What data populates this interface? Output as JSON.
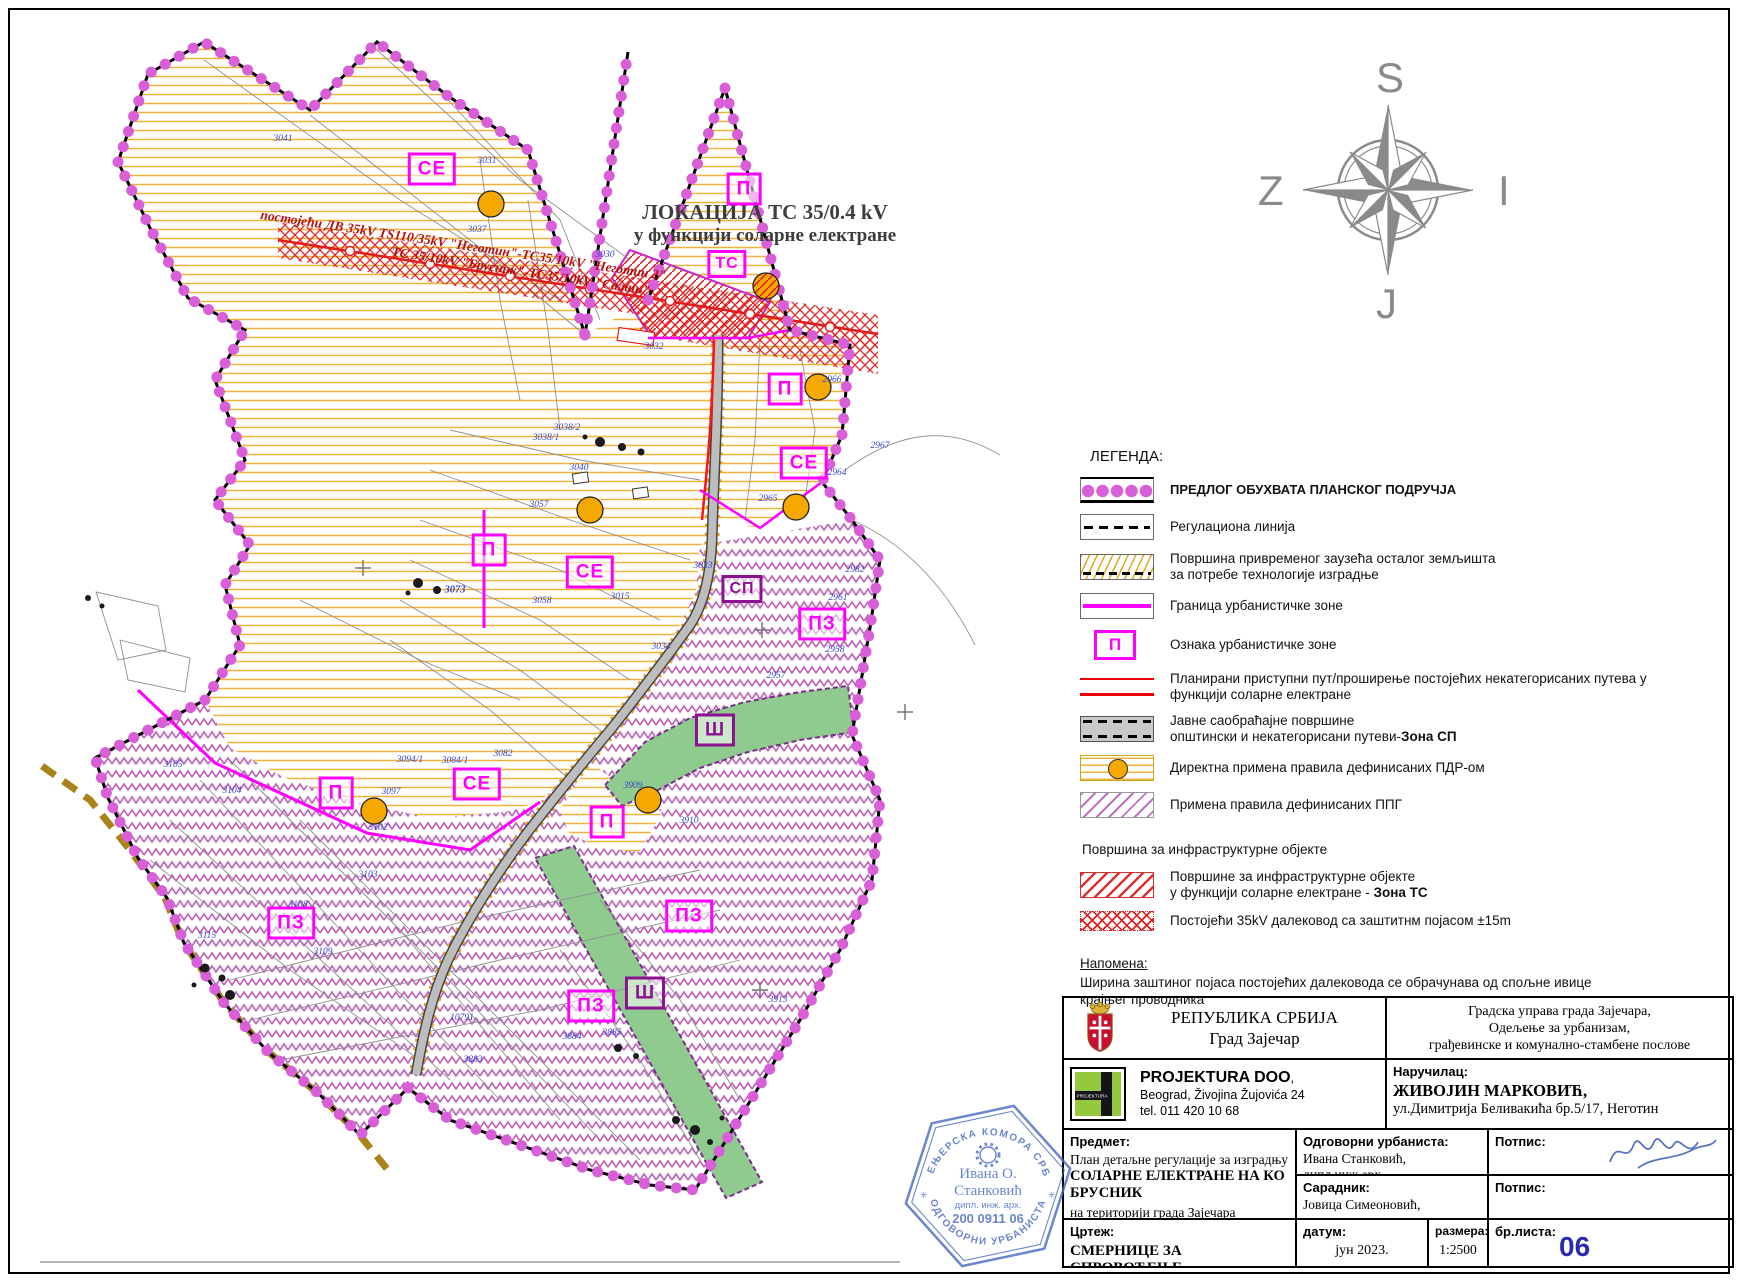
{
  "colors": {
    "accent_magenta": "#ff00ff",
    "boundary_dots": "#d95fd9",
    "dark_zone": "#8b1191",
    "yellow_hatch": "#efb23a",
    "purple_hatch": "#bb63bb",
    "green_zone": "#8fca8f",
    "red_corridor": "#e31b1b",
    "blue_parcel": "#3747cf",
    "sheet_number_blue": "#2b2bb0",
    "stamp_blue": "#4a6cc4",
    "compass_gray": "#8a8a8a"
  },
  "map": {
    "title": {
      "line1": "ЛОКАЦИЈА ТС 35/0.4 kV",
      "line2": "у функцији соларне електране"
    },
    "powerline_label": {
      "line1": "постојећи ДВ 35kV TS110/35kV \"Неготин\"-ТС35/10kV \"Неготин 2\"",
      "line2": "ТС 35/10kV \"Брусник\"-ТС35/10kV \"Салаш\""
    },
    "zone_labels": [
      {
        "text": "СЕ",
        "x": 432,
        "y": 169,
        "style": ""
      },
      {
        "text": "П",
        "x": 744,
        "y": 189,
        "style": ""
      },
      {
        "text": "ТС",
        "x": 727,
        "y": 264,
        "style": "small"
      },
      {
        "text": "П",
        "x": 785,
        "y": 389,
        "style": ""
      },
      {
        "text": "СЕ",
        "x": 804,
        "y": 463,
        "style": ""
      },
      {
        "text": "П",
        "x": 489,
        "y": 550,
        "style": ""
      },
      {
        "text": "СЕ",
        "x": 590,
        "y": 572,
        "style": ""
      },
      {
        "text": "СП",
        "x": 742,
        "y": 589,
        "style": "dark small"
      },
      {
        "text": "ПЗ",
        "x": 822,
        "y": 624,
        "style": ""
      },
      {
        "text": "Ш",
        "x": 715,
        "y": 730,
        "style": "dark"
      },
      {
        "text": "СЕ",
        "x": 477,
        "y": 784,
        "style": ""
      },
      {
        "text": "П",
        "x": 336,
        "y": 793,
        "style": ""
      },
      {
        "text": "П",
        "x": 607,
        "y": 822,
        "style": ""
      },
      {
        "text": "ПЗ",
        "x": 291,
        "y": 923,
        "style": ""
      },
      {
        "text": "ПЗ",
        "x": 689,
        "y": 916,
        "style": ""
      },
      {
        "text": "Ш",
        "x": 645,
        "y": 993,
        "style": "dark"
      },
      {
        "text": "ПЗ",
        "x": 591,
        "y": 1006,
        "style": ""
      }
    ],
    "parcel_numbers": [
      {
        "text": "3041",
        "x": 283,
        "y": 139
      },
      {
        "text": "3031",
        "x": 487,
        "y": 161
      },
      {
        "text": "3037",
        "x": 477,
        "y": 230
      },
      {
        "text": "3030",
        "x": 605,
        "y": 255
      },
      {
        "text": "3032",
        "x": 654,
        "y": 347
      },
      {
        "text": "3038/2",
        "x": 567,
        "y": 428
      },
      {
        "text": "3038/1",
        "x": 546,
        "y": 438
      },
      {
        "text": "3040",
        "x": 579,
        "y": 468
      },
      {
        "text": "3057",
        "x": 539,
        "y": 505
      },
      {
        "text": "3073",
        "x": 455,
        "y": 590,
        "bold": true
      },
      {
        "text": "3058",
        "x": 542,
        "y": 601
      },
      {
        "text": "3015",
        "x": 620,
        "y": 597
      },
      {
        "text": "3033",
        "x": 703,
        "y": 566
      },
      {
        "text": "3034",
        "x": 661,
        "y": 647
      },
      {
        "text": "2966",
        "x": 832,
        "y": 380
      },
      {
        "text": "2964",
        "x": 837,
        "y": 473
      },
      {
        "text": "2965",
        "x": 768,
        "y": 499
      },
      {
        "text": "2967",
        "x": 880,
        "y": 446
      },
      {
        "text": "2982",
        "x": 855,
        "y": 570
      },
      {
        "text": "2961",
        "x": 838,
        "y": 598
      },
      {
        "text": "2958",
        "x": 835,
        "y": 650
      },
      {
        "text": "2957",
        "x": 776,
        "y": 676
      },
      {
        "text": "3105",
        "x": 173,
        "y": 765
      },
      {
        "text": "3104",
        "x": 232,
        "y": 791
      },
      {
        "text": "3097",
        "x": 391,
        "y": 792
      },
      {
        "text": "3102",
        "x": 378,
        "y": 828
      },
      {
        "text": "3094/1",
        "x": 410,
        "y": 760
      },
      {
        "text": "3084/1",
        "x": 455,
        "y": 761
      },
      {
        "text": "3082",
        "x": 503,
        "y": 754
      },
      {
        "text": "3103",
        "x": 368,
        "y": 875
      },
      {
        "text": "3108",
        "x": 298,
        "y": 905
      },
      {
        "text": "3115",
        "x": 207,
        "y": 936
      },
      {
        "text": "3109",
        "x": 323,
        "y": 952
      },
      {
        "text": "10791",
        "x": 462,
        "y": 1018
      },
      {
        "text": "3885",
        "x": 612,
        "y": 1033
      },
      {
        "text": "3884",
        "x": 572,
        "y": 1037
      },
      {
        "text": "3883",
        "x": 473,
        "y": 1060
      },
      {
        "text": "3913",
        "x": 778,
        "y": 1000
      },
      {
        "text": "3910",
        "x": 689,
        "y": 821
      },
      {
        "text": "3909",
        "x": 633,
        "y": 786
      }
    ],
    "symbols": {
      "pdr_circles": [
        {
          "x": 491,
          "y": 204
        },
        {
          "x": 818,
          "y": 387
        },
        {
          "x": 796,
          "y": 507
        },
        {
          "x": 590,
          "y": 510
        },
        {
          "x": 374,
          "y": 811
        },
        {
          "x": 648,
          "y": 800
        }
      ],
      "ts_circle": {
        "x": 766,
        "y": 286
      }
    }
  },
  "compass": {
    "north": "S",
    "west": "Z",
    "east": "I",
    "south": "J"
  },
  "legend": {
    "title": "ЛЕГЕНДА:",
    "items": [
      {
        "swatch": "dots",
        "bold": true,
        "lines": [
          "ПРЕДЛОГ ОБУХВАТА ПЛАНСКОГ ПОДРУЧЈА"
        ]
      },
      {
        "swatch": "dash",
        "lines": [
          "Регулациона линија"
        ]
      },
      {
        "swatch": "temp",
        "lines": [
          "Површина привременог заузећа осталог земљишта",
          "за потребе технологије изградње"
        ]
      },
      {
        "swatch": "magline",
        "lines": [
          "Граница урбанистичке зоне"
        ]
      },
      {
        "swatch": "pbox",
        "letter": "П",
        "lines": [
          "Ознака урбанистичке зоне"
        ]
      },
      {
        "swatch": "redlines",
        "lines": [
          "Планирани приступни пут/проширење постојећих некатегорисаних путева у",
          "функцији соларне електране"
        ]
      },
      {
        "swatch": "road",
        "lines": [
          "Јавне саобраћајне површине",
          "општински и некатегорисани путеви-<b>Зона СП</b>"
        ]
      },
      {
        "swatch": "pdr",
        "lines": [
          "Директна примена правила дефинисаних ПДР-ом"
        ]
      },
      {
        "swatch": "ppg",
        "lines": [
          "Примена правила дефинисаних ППГ"
        ]
      }
    ],
    "subtitle": "Површина за инфраструктурне објекте",
    "sub_items": [
      {
        "swatch": "infra",
        "lines": [
          "Површине за инфраструктурне објекте",
          "у функцији соларне електране - <b>Зона ТС</b>"
        ]
      },
      {
        "swatch": "dalekovod",
        "lines": [
          "Постојећи 35kV далековод са заштитнм појасом ±15m"
        ]
      }
    ],
    "note_title": "Напомена:",
    "note_lines": [
      "Ширина заштиног појаса постојећих далековода се обрачунава од спољне ивице",
      "крајњег проводника"
    ]
  },
  "title_block": {
    "republic": {
      "line1": "РЕПУБЛИКА СРБИЈА",
      "line2": "Град Зајечар"
    },
    "authority": {
      "line1": "Градска управа града Зајечара,",
      "line2": "Одељење за урбанизам,",
      "line3": "грађевинске и комунално-стамбене послове"
    },
    "company": {
      "name": "PROJEKTURA DOO",
      "suffix": ",",
      "addr": "Beograd, Živojina Žujovića 24",
      "tel": "tel. 011 420 10 68",
      "logo_text": "PROJEKTURA"
    },
    "client": {
      "label": "Наручилац:",
      "name": "ЖИВОЈИН МАРКОВИЋ,",
      "addr": "ул.Димитрија Беливакића бр.5/17, Неготин"
    },
    "subject": {
      "label": "Предмет:",
      "line1": "План детаљне регулације за изградњу",
      "line2": "СОЛАРНЕ ЕЛЕКТРАНЕ НА КО БРУСНИК",
      "line3": "на територији града Зајечара"
    },
    "urbanist": {
      "label": "Одговорни урбаниста:",
      "name": "Ивана Станковић, дипл.инж.арх."
    },
    "associate": {
      "label": "Сарадник:",
      "name": "Јовица Симеоновић, дипл.инж.арх."
    },
    "signature_label1": "Потпис:",
    "signature_label2": "Потпис:",
    "drawing": {
      "label": "Цртеж:",
      "name": "СМЕРНИЦЕ ЗА СПРОВОЂЕЊЕ"
    },
    "date": {
      "label": "датум:",
      "value": "јун 2023."
    },
    "scale": {
      "label": "размера:",
      "value": "1:2500"
    },
    "sheet": {
      "label": "бр.листа:",
      "value": "06"
    }
  },
  "stamp": {
    "ring_top": "ИНЖЕЊЕРСКА КОМОРА СРБИЈЕ",
    "name1": "Ивана О.",
    "name2": "Станковић",
    "prof": "дипл. инж. арх.",
    "number": "200 0911 06",
    "ring_bottom": "ОДГОВОРНИ УРБАНИСТА"
  }
}
